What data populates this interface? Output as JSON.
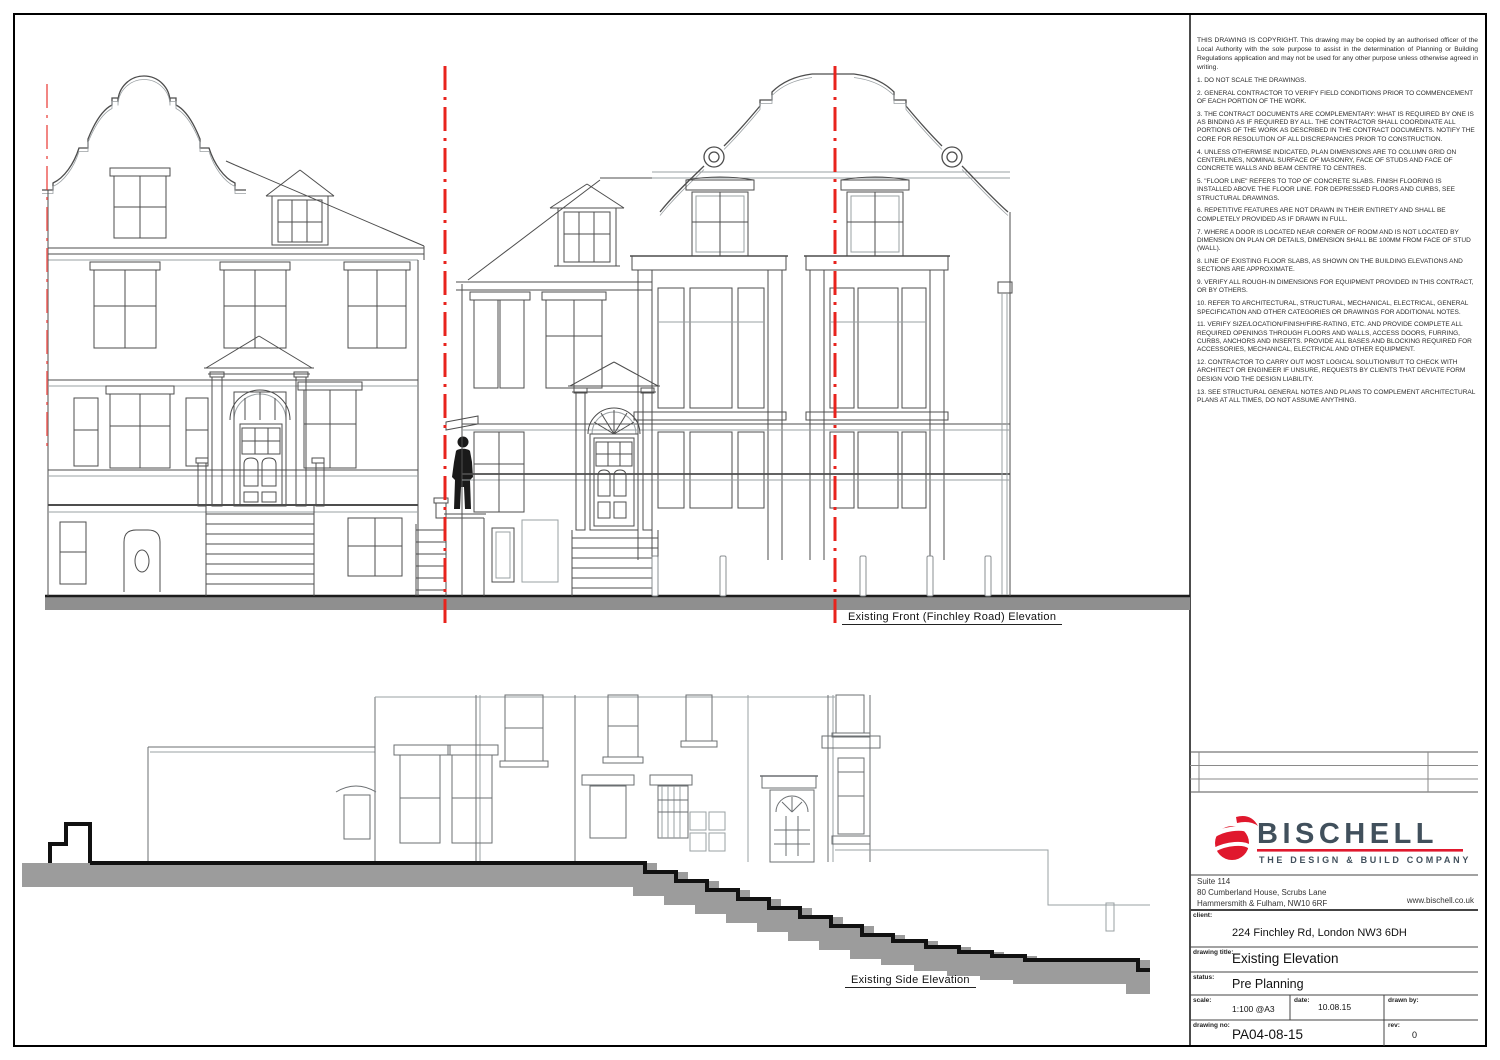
{
  "labels": {
    "front": "Existing Front  (Finchley Road) Elevation",
    "side": "Existing Side Elevation"
  },
  "notes": {
    "copyright": "THIS DRAWING IS COPYRIGHT. This drawing may be copied by an authorised officer of the Local Authority with the sole purpose to assist in the determination of Planning or Building Regulations application and may not be used for any other purpose unless otherwise agreed in writing.",
    "items": [
      "1. DO NOT SCALE THE DRAWINGS.",
      "2. GENERAL CONTRACTOR TO VERIFY FIELD CONDITIONS PRIOR TO COMMENCEMENT OF EACH PORTION OF THE WORK.",
      "3. THE CONTRACT DOCUMENTS ARE COMPLEMENTARY: WHAT IS REQUIRED BY ONE IS AS BINDING AS IF REQUIRED BY ALL. THE CONTRACTOR SHALL COORDINATE ALL PORTIONS OF THE WORK AS DESCRIBED IN THE CONTRACT DOCUMENTS. NOTIFY THE CORE FOR RESOLUTION OF ALL DISCREPANCIES PRIOR TO CONSTRUCTION.",
      "4. UNLESS OTHERWISE INDICATED, PLAN DIMENSIONS ARE TO COLUMN GRID ON CENTERLINES, NOMINAL SURFACE OF MASONRY, FACE OF STUDS AND FACE OF CONCRETE WALLS AND BEAM CENTRE TO CENTRES.",
      "5. \"FLOOR LINE\" REFERS TO TOP OF CONCRETE SLABS. FINISH FLOORING IS INSTALLED ABOVE THE FLOOR LINE. FOR DEPRESSED FLOORS AND CURBS, SEE STRUCTURAL DRAWINGS.",
      "6. REPETITIVE FEATURES ARE NOT DRAWN IN THEIR ENTIRETY AND SHALL BE COMPLETELY PROVIDED AS IF DRAWN IN FULL.",
      "7. WHERE A DOOR IS LOCATED NEAR CORNER OF ROOM AND IS NOT LOCATED BY DIMENSION ON PLAN OR DETAILS, DIMENSION SHALL BE 100MM FROM FACE OF STUD (WALL).",
      "8. LINE OF EXISTING FLOOR SLABS, AS SHOWN ON THE BUILDING ELEVATIONS AND SECTIONS ARE APPROXIMATE.",
      "9. VERIFY ALL ROUGH-IN DIMENSIONS FOR EQUIPMENT PROVIDED IN THIS CONTRACT, OR BY OTHERS.",
      "10. REFER TO ARCHITECTURAL, STRUCTURAL, MECHANICAL, ELECTRICAL, GENERAL SPECIFICATION AND OTHER CATEGORIES OR DRAWINGS FOR ADDITIONAL NOTES.",
      "11. VERIFY SIZE/LOCATION/FINISH/FIRE-RATING, ETC. AND PROVIDE COMPLETE ALL REQUIRED OPENINGS THROUGH FLOORS AND WALLS, ACCESS DOORS, FURRING, CURBS, ANCHORS AND INSERTS. PROVIDE ALL BASES AND BLOCKING REQUIRED FOR ACCESSORIES, MECHANICAL, ELECTRICAL AND OTHER EQUIPMENT.",
      "12. CONTRACTOR TO CARRY OUT MOST LOGICAL SOLUTION/BUT TO CHECK WITH ARCHITECT OR ENGINEER IF UNSURE, REQUESTS BY CLIENTS THAT DEVIATE FORM DESIGN VOID THE DESIGN LIABILITY.",
      "13. SEE STRUCTURAL GENERAL NOTES AND PLANS TO COMPLEMENT ARCHITECTURAL PLANS AT ALL TIMES, DO NOT ASSUME ANYTHING."
    ]
  },
  "company": {
    "name": "BISCHELL",
    "tagline": "THE DESIGN & BUILD COMPANY",
    "brand_red": "#e0182d",
    "brand_slate": "#41505c",
    "address_line1": "Suite 114",
    "address_line2": "80 Cumberland House,  Scrubs Lane",
    "address_line3": "Hammersmith & Fulham,  NW10 6RF",
    "website": "www.bischell.co.uk"
  },
  "titleblock": {
    "client_label": "client:",
    "client": "224 Finchley Rd, London NW3 6DH",
    "drawing_title_label": "drawing title:",
    "drawing_title": "Existing Elevation",
    "status_label": "status:",
    "status": "Pre Planning",
    "scale_label": "scale:",
    "scale": "1:100 @A3",
    "date_label": "date:",
    "date": "10.08.15",
    "drawn_by_label": "drawn by:",
    "drawn_by": "",
    "drawing_no_label": "drawing no:",
    "drawing_no": "PA04-08-15",
    "rev_label": "rev:",
    "rev": "0"
  }
}
